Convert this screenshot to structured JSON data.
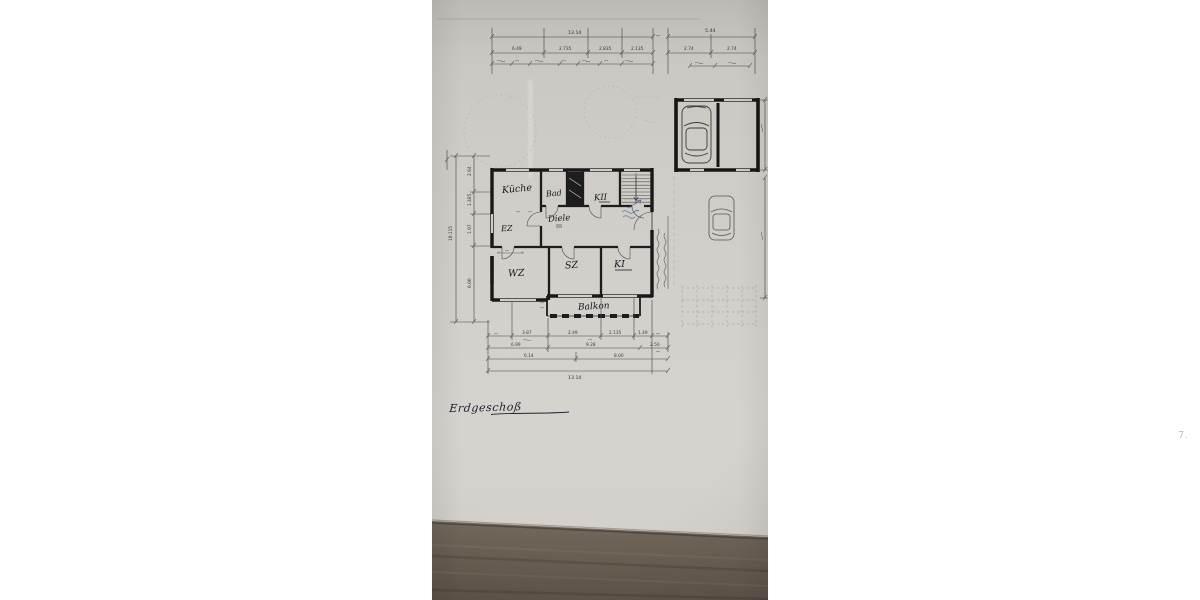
{
  "scene": {
    "description": "Photograph of a hand-drafted ground-floor architectural plan on grey paper lying on a dark wooden table",
    "palette": {
      "page_margin": "#ffffff",
      "paper": "#cdcac5",
      "ink": "#1c1c1c",
      "pencil": "#97948c",
      "pen_blue": "#3b4d8f",
      "wood": "#6d6257"
    }
  },
  "plan": {
    "title": "Erdgeschoß",
    "rooms": {
      "kueche": "Küche",
      "bad": "Bad",
      "kii": "KII",
      "ez": "EZ",
      "diele": "Diele",
      "wz": "WZ",
      "sz": "SZ",
      "ki": "KI",
      "balkon": "Balkon"
    },
    "dims": {
      "top_total_left": "13.14",
      "top_total_right": "5.44",
      "top_row": [
        "6.49",
        "2.735",
        "2.835",
        "2.135"
      ],
      "top_right_row": [
        "2.74",
        "2.74"
      ],
      "left_total": "10.115",
      "left_row": [
        "2.94",
        "1.485",
        "1.97",
        "6.00"
      ],
      "bottom_row1": [
        "3.87",
        "2.49",
        "2.135",
        "1.49"
      ],
      "bottom_row2": [
        "6.99",
        "9.28",
        "2.50"
      ],
      "bottom_row3": [
        "6.14",
        "8.00"
      ],
      "bottom_total": "13.14"
    },
    "margin_mark": "7."
  }
}
